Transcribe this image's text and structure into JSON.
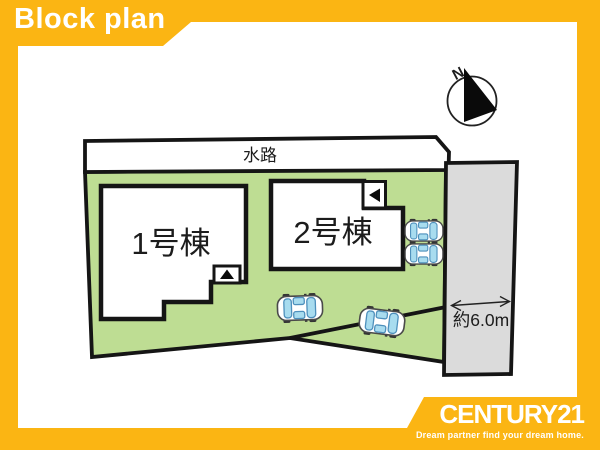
{
  "banner": {
    "label": "Block plan"
  },
  "site_plan": {
    "waterway": {
      "label": "水路"
    },
    "buildings": [
      {
        "label": "1号棟"
      },
      {
        "label": "2号棟"
      }
    ],
    "road": {
      "width_label": "約6.0m"
    },
    "compass": {
      "label": "N"
    }
  },
  "footer": {
    "brand": "CENTURY21",
    "tagline": "Dream partner find your dream home."
  },
  "colors": {
    "accent_yellow": "#FBB513",
    "site_green": "#BEDD93",
    "road_gray": "#DBDBDB",
    "outline_black": "#151515",
    "car_window_blue": "#A8DCEF"
  }
}
